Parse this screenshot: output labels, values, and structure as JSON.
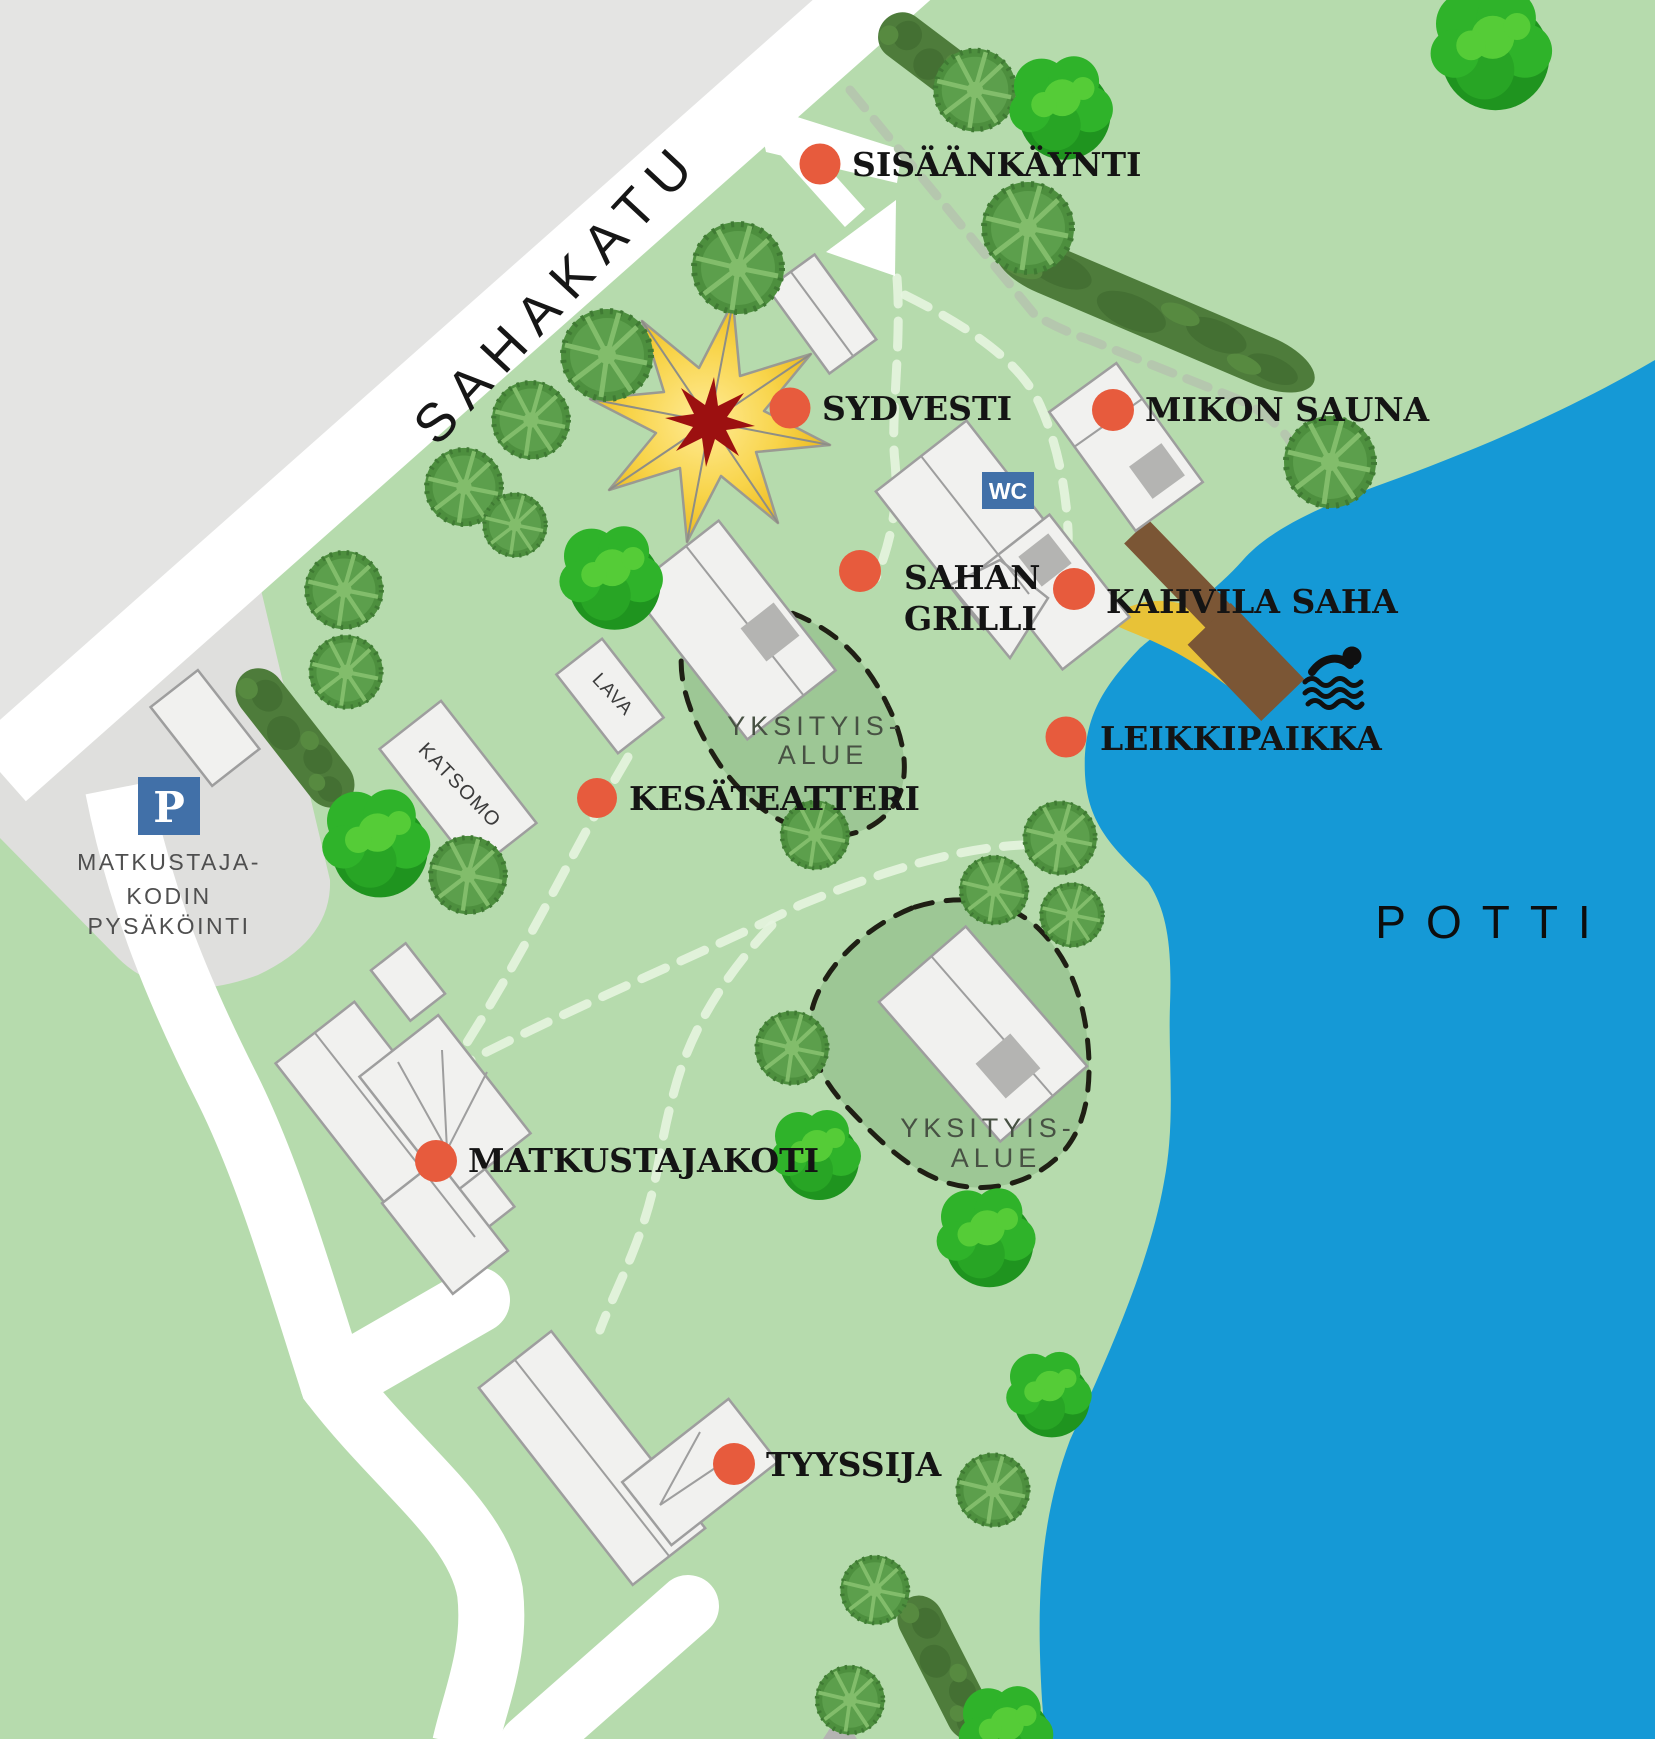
{
  "map": {
    "street": "SAHAKATU",
    "water_name": "POTTI",
    "parking": {
      "icon": "P",
      "line1": "MATKUSTAJA-",
      "line2": "KODIN",
      "line3": "PYSÄKÖINTI"
    },
    "wc_sign": "WC",
    "private_area1": {
      "line1": "YKSITYIS-",
      "line2": "ALUE"
    },
    "private_area2": {
      "line1": "YKSITYIS-",
      "line2": "ALUE"
    },
    "buildings": {
      "lava": "LAVA",
      "katsomo": "KATSOMO"
    },
    "pois": [
      {
        "id": "sisaankaynti",
        "label": "SISÄÄNKÄYNTI"
      },
      {
        "id": "sydvesti",
        "label": "SYDVESTI"
      },
      {
        "id": "mikon-sauna",
        "label": "MIKON SAUNA"
      },
      {
        "id": "sahan-grilli",
        "label1": "SAHAN",
        "label2": "GRILLI"
      },
      {
        "id": "kahvila-saha",
        "label": "KAHVILA SAHA"
      },
      {
        "id": "leikkipaikka",
        "label": "LEIKKIPAIKKA"
      },
      {
        "id": "kesateatteri",
        "label": "KESÄTEATTERI"
      },
      {
        "id": "matkustajakoti",
        "label": "MATKUSTAJAKOTI"
      },
      {
        "id": "tyyssija",
        "label": "TYYSSIJA"
      }
    ],
    "icons": [
      "parking-icon",
      "wc-icon",
      "swimmer-icon",
      "entrance-arrow-icon"
    ],
    "colors": {
      "grass": "#b6dbad",
      "private_grass": "#9dc795",
      "water": "#1599d6",
      "outside_gray": "#e4e4e3",
      "parking_gray": "#dfdfdd",
      "road": "#ffffff",
      "marker": "#e75b3d",
      "beach": "#e8c237",
      "pier": "#7b5635",
      "sign_blue": "#4170a8",
      "tent_yellow": "#f3c41f",
      "tent_red": "#9c1010"
    }
  }
}
